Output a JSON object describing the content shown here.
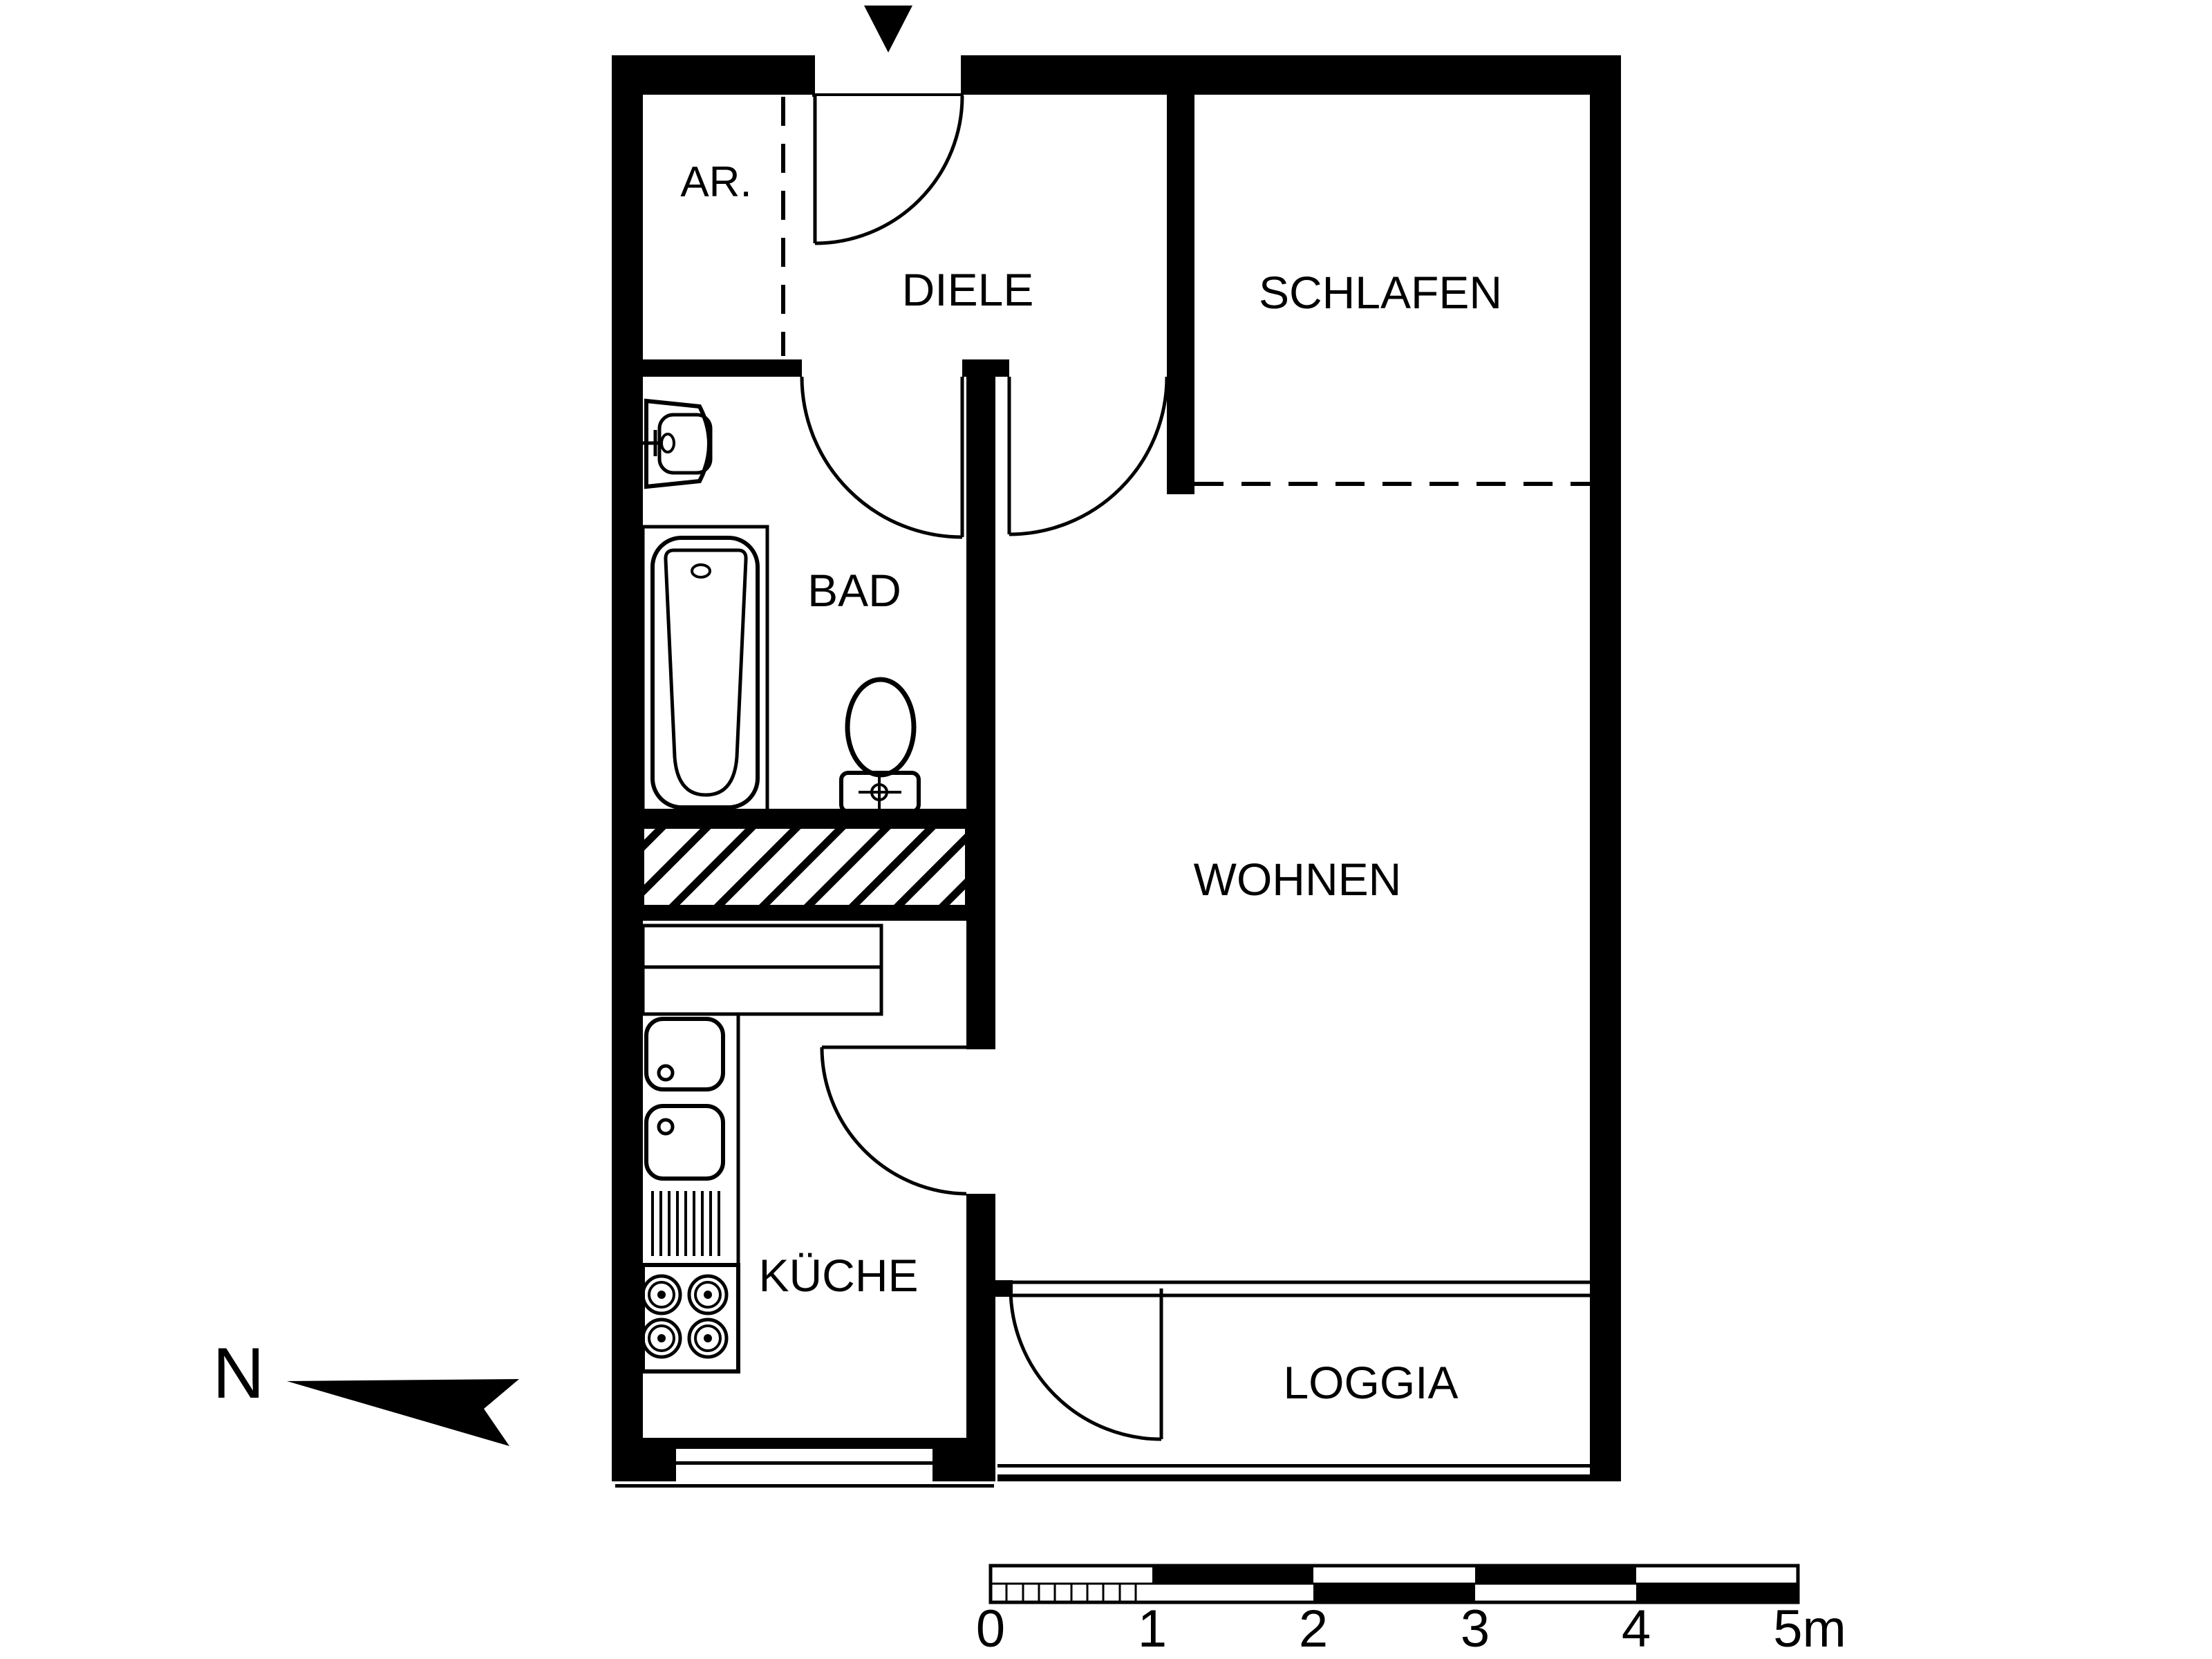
{
  "colors": {
    "line": "#000000",
    "background": "#ffffff"
  },
  "rooms": {
    "ar": {
      "label": "AR."
    },
    "diele": {
      "label": "DIELE"
    },
    "schlafen": {
      "label": "SCHLAFEN"
    },
    "bad": {
      "label": "BAD"
    },
    "wohnen": {
      "label": "WOHNEN"
    },
    "kueche": {
      "label": "KÜCHE"
    },
    "loggia": {
      "label": "LOGGIA"
    }
  },
  "north": {
    "label": "N"
  },
  "scale_bar": {
    "unit_labels": [
      "0",
      "1",
      "2",
      "3",
      "4",
      "5m"
    ],
    "total_meters": 5,
    "major_interval_m": 1,
    "minor_subdivisions_first_meter": 10
  }
}
